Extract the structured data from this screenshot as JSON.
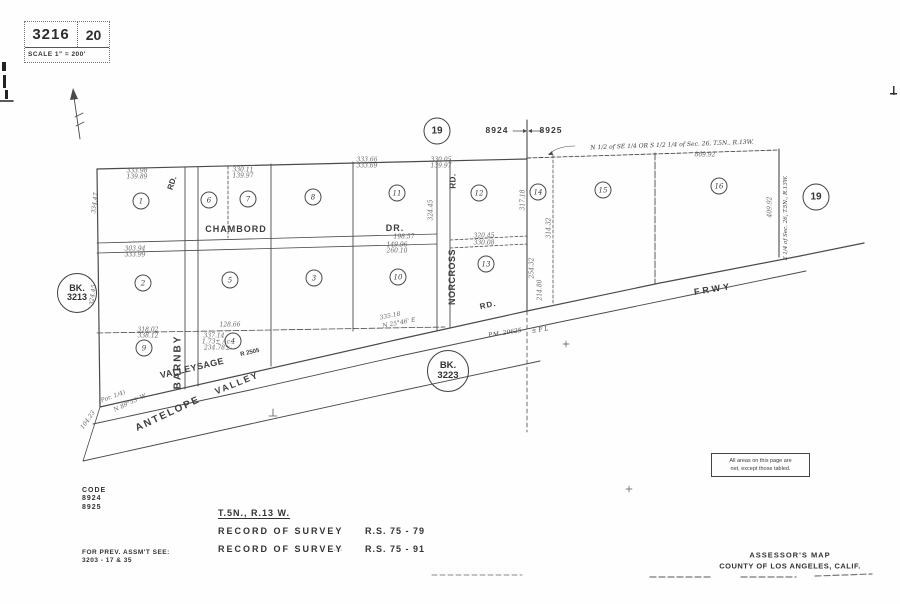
{
  "header": {
    "book": "3216",
    "page": "20",
    "scale": "SCALE 1\" = 200'"
  },
  "section_markers": {
    "left_code": "8924",
    "right_code": "8925",
    "circle_top": "19",
    "circle_right": "19"
  },
  "bk": {
    "left": {
      "line1": "BK.",
      "line2": "3213"
    },
    "lower": {
      "line1": "BK.",
      "line2": "3223"
    }
  },
  "annotations": {
    "note_line1": "All areas on this page are",
    "note_line2": "net, except those tabled."
  },
  "parcels": [
    {
      "circle": "1",
      "lot": "",
      "note": "",
      "acreage": "2.27 Ac.",
      "acreage2": "",
      "x": 141,
      "y": 201
    },
    {
      "circle": "6",
      "lot": "",
      "note": "N 1/2",
      "acreage": "2.52± Ac.",
      "acreage2": "",
      "x": 209,
      "y": 200
    },
    {
      "circle": "7",
      "lot": "",
      "note": "S 1/2",
      "acreage": "1.73± Ac.",
      "acreage2": "",
      "x": 248,
      "y": 199
    },
    {
      "circle": "8",
      "lot": "9",
      "note": "",
      "acreage": "2.24 Ac.",
      "acreage2": "",
      "x": 313,
      "y": 197
    },
    {
      "circle": "11",
      "lot": "16",
      "note": "",
      "acreage": "2.09 Ac.",
      "acreage2": "",
      "x": 397,
      "y": 193
    },
    {
      "circle": "12",
      "lot": "1",
      "note": "",
      "acreage": "2.03 Ac.",
      "acreage2": "",
      "x": 479,
      "y": 193
    },
    {
      "circle": "2",
      "lot": "2",
      "note": "",
      "acreage": "2.10 Ac.",
      "acreage2": "",
      "x": 143,
      "y": 283
    },
    {
      "circle": "5",
      "lot": "7",
      "note": "",
      "acreage": "2.04 Ac.",
      "acreage2": "",
      "x": 230,
      "y": 280
    },
    {
      "circle": "3",
      "lot": "10",
      "note": "",
      "acreage": "2.28± Ac.",
      "acreage2": "2.32± Ac.",
      "x": 314,
      "y": 278
    },
    {
      "circle": "10",
      "lot": "15",
      "note": "",
      "acreage": "1.74 ± Ac.",
      "acreage2": "",
      "x": 398,
      "y": 277
    },
    {
      "circle": "13",
      "lot": "2",
      "note": "",
      "acreage": "1.94 Ac.",
      "acreage2": "",
      "x": 486,
      "y": 264
    },
    {
      "circle": "9",
      "lot": "3",
      "note": "",
      "acreage": "1.60 Ac.",
      "acreage2": "",
      "x": 144,
      "y": 348
    },
    {
      "circle": "4",
      "lot": "",
      "note": "",
      "acreage": "",
      "acreage2": "",
      "x": 233,
      "y": 341
    },
    {
      "circle": "14",
      "lot": "",
      "note": "",
      "acreage": "2.51± Ac.",
      "acreage2": "",
      "x": 538,
      "y": 192
    },
    {
      "circle": "15",
      "lot": "",
      "note": "",
      "acreage": "5.17± Ac.",
      "acreage2": "",
      "x": 603,
      "y": 190
    },
    {
      "circle": "16",
      "lot": "",
      "note": "",
      "acreage": "3.775 Ac.",
      "acreage2": "",
      "x": 719,
      "y": 186
    }
  ],
  "labels": [
    {
      "name": "street-chambord",
      "t": "CHAMBORD",
      "x": 236,
      "y": 229,
      "r": 0,
      "fs": 9,
      "ls": 1
    },
    {
      "name": "street-chambord-dr",
      "t": "DR.",
      "x": 395,
      "y": 228,
      "r": 0,
      "fs": 9,
      "ls": 1
    },
    {
      "name": "street-norcross",
      "t": "NORCROSS",
      "x": 452,
      "y": 277,
      "r": -90,
      "fs": 9,
      "ls": 0.5
    },
    {
      "name": "street-norcross-rd",
      "t": "RD.",
      "x": 453,
      "y": 181,
      "r": -90,
      "fs": 8,
      "ls": 0.5
    },
    {
      "name": "street-barnby",
      "t": "BARNBY",
      "x": 178,
      "y": 362,
      "r": -90,
      "fs": 10,
      "ls": 2
    },
    {
      "name": "street-barnby-rd",
      "t": "RD.",
      "x": 172,
      "y": 183,
      "r": -72,
      "fs": 8,
      "ls": 0
    },
    {
      "name": "street-valleysage",
      "t": "VALLEYSAGE",
      "x": 192,
      "y": 368,
      "r": -13,
      "fs": 9,
      "ls": 0.5
    },
    {
      "name": "road-number-label",
      "t": "R 2505",
      "x": 250,
      "y": 353,
      "r": -13,
      "fs": 6,
      "ls": 0
    },
    {
      "name": "street-antelope",
      "t": "ANTELOPE",
      "x": 168,
      "y": 414,
      "r": -25,
      "fs": 10,
      "ls": 2
    },
    {
      "name": "street-valley",
      "t": "VALLEY",
      "x": 237,
      "y": 383,
      "r": -22,
      "fs": 9,
      "ls": 2
    },
    {
      "name": "street-frwy",
      "t": "FRWY",
      "x": 713,
      "y": 289,
      "r": -9,
      "fs": 9,
      "ls": 3
    },
    {
      "name": "street-valleysage-rd",
      "t": "RD.",
      "x": 488,
      "y": 305,
      "r": -12,
      "fs": 8,
      "ls": 1
    },
    {
      "name": "parcel-map-number",
      "t": "P.M. 20625",
      "x": 505,
      "y": 333,
      "r": -9,
      "fs": 6,
      "ls": 0,
      "it": 1
    },
    {
      "name": "parcel-map-suffix",
      "t": "± F L",
      "x": 540,
      "y": 330,
      "r": -9,
      "fs": 6,
      "ls": 0,
      "it": 1
    },
    {
      "name": "aliquot-annotation",
      "t": "N 1/2 of SE 1/4 OR S 1/2 1/4 of Sec. 26, T.5N., R.13W.",
      "x": 672,
      "y": 145,
      "r": -2,
      "fs": 6,
      "ls": 0,
      "it": 1
    },
    {
      "name": "east-edge-annotation",
      "t": "E 1/4 of Sec. 26, T.5N., R.13W.",
      "x": 786,
      "y": 218,
      "r": -90,
      "fs": 5.5,
      "ls": 0,
      "it": 1
    }
  ],
  "dims": [
    {
      "t": "333.98",
      "x": 137,
      "y": 171
    },
    {
      "t": "139.89",
      "x": 137,
      "y": 177
    },
    {
      "t": "330.11",
      "x": 243,
      "y": 170
    },
    {
      "t": "139.97",
      "x": 243,
      "y": 176
    },
    {
      "t": "333.66",
      "x": 367,
      "y": 160
    },
    {
      "t": "333.69",
      "x": 367,
      "y": 166
    },
    {
      "t": "330.05",
      "x": 441,
      "y": 160
    },
    {
      "t": "139.97",
      "x": 441,
      "y": 166
    },
    {
      "t": "869.92",
      "x": 705,
      "y": 155
    },
    {
      "t": "303.94",
      "x": 135,
      "y": 249
    },
    {
      "t": "333.99",
      "x": 135,
      "y": 255
    },
    {
      "t": "149.96",
      "x": 397,
      "y": 245
    },
    {
      "t": "260.10",
      "x": 397,
      "y": 251
    },
    {
      "t": "198.57",
      "x": 404,
      "y": 237
    },
    {
      "t": "318.02",
      "x": 148,
      "y": 330
    },
    {
      "t": "338.12",
      "x": 148,
      "y": 336
    },
    {
      "t": "128.66",
      "x": 230,
      "y": 325
    },
    {
      "t": "335.18",
      "x": 390,
      "y": 316,
      "r": -11
    },
    {
      "t": "N 25°46' E",
      "x": 399,
      "y": 323,
      "r": -11
    },
    {
      "t": "320.45",
      "x": 484,
      "y": 236
    },
    {
      "t": "330.08",
      "x": 484,
      "y": 243
    },
    {
      "t": "317.18",
      "x": 523,
      "y": 200,
      "r": -90
    },
    {
      "t": "254.32",
      "x": 532,
      "y": 268,
      "r": -90
    },
    {
      "t": "214.80",
      "x": 540,
      "y": 290,
      "r": -90
    },
    {
      "t": "314.32",
      "x": 549,
      "y": 228,
      "r": -90
    },
    {
      "t": "409.92",
      "x": 770,
      "y": 207,
      "r": -90
    },
    {
      "t": "334.47",
      "x": 95,
      "y": 203,
      "r": -83
    },
    {
      "t": "324.45",
      "x": 93,
      "y": 295,
      "r": -83
    },
    {
      "t": "324.45",
      "x": 431,
      "y": 210,
      "r": -90
    },
    {
      "t": "(Por. 1/4)",
      "x": 112,
      "y": 397,
      "r": -20
    },
    {
      "t": "N 89°53' W",
      "x": 130,
      "y": 403,
      "r": -25
    },
    {
      "t": "104.23",
      "x": 88,
      "y": 420,
      "r": -55
    },
    {
      "t": "337.14",
      "x": 214,
      "y": 336
    },
    {
      "t": "1.73± Ac.",
      "x": 217,
      "y": 342
    },
    {
      "t": "234.78±",
      "x": 217,
      "y": 348
    },
    {
      "t": ".. ..",
      "x": 338,
      "y": 549
    }
  ],
  "footer": {
    "code_label": "CODE",
    "code1": "8924",
    "code2": "8925",
    "township": "T.5N., R.13 W.",
    "records": [
      {
        "label": "RECORD OF SURVEY",
        "value": "R.S. 75 - 79"
      },
      {
        "label": "RECORD OF SURVEY",
        "value": "R.S. 75 - 91"
      }
    ],
    "prev_line1": "FOR PREV. ASSM'T SEE:",
    "prev_line2": "3203  - 17 & 35",
    "map_title": "ASSESSOR'S MAP",
    "county": "COUNTY OF LOS ANGELES, CALIF."
  }
}
